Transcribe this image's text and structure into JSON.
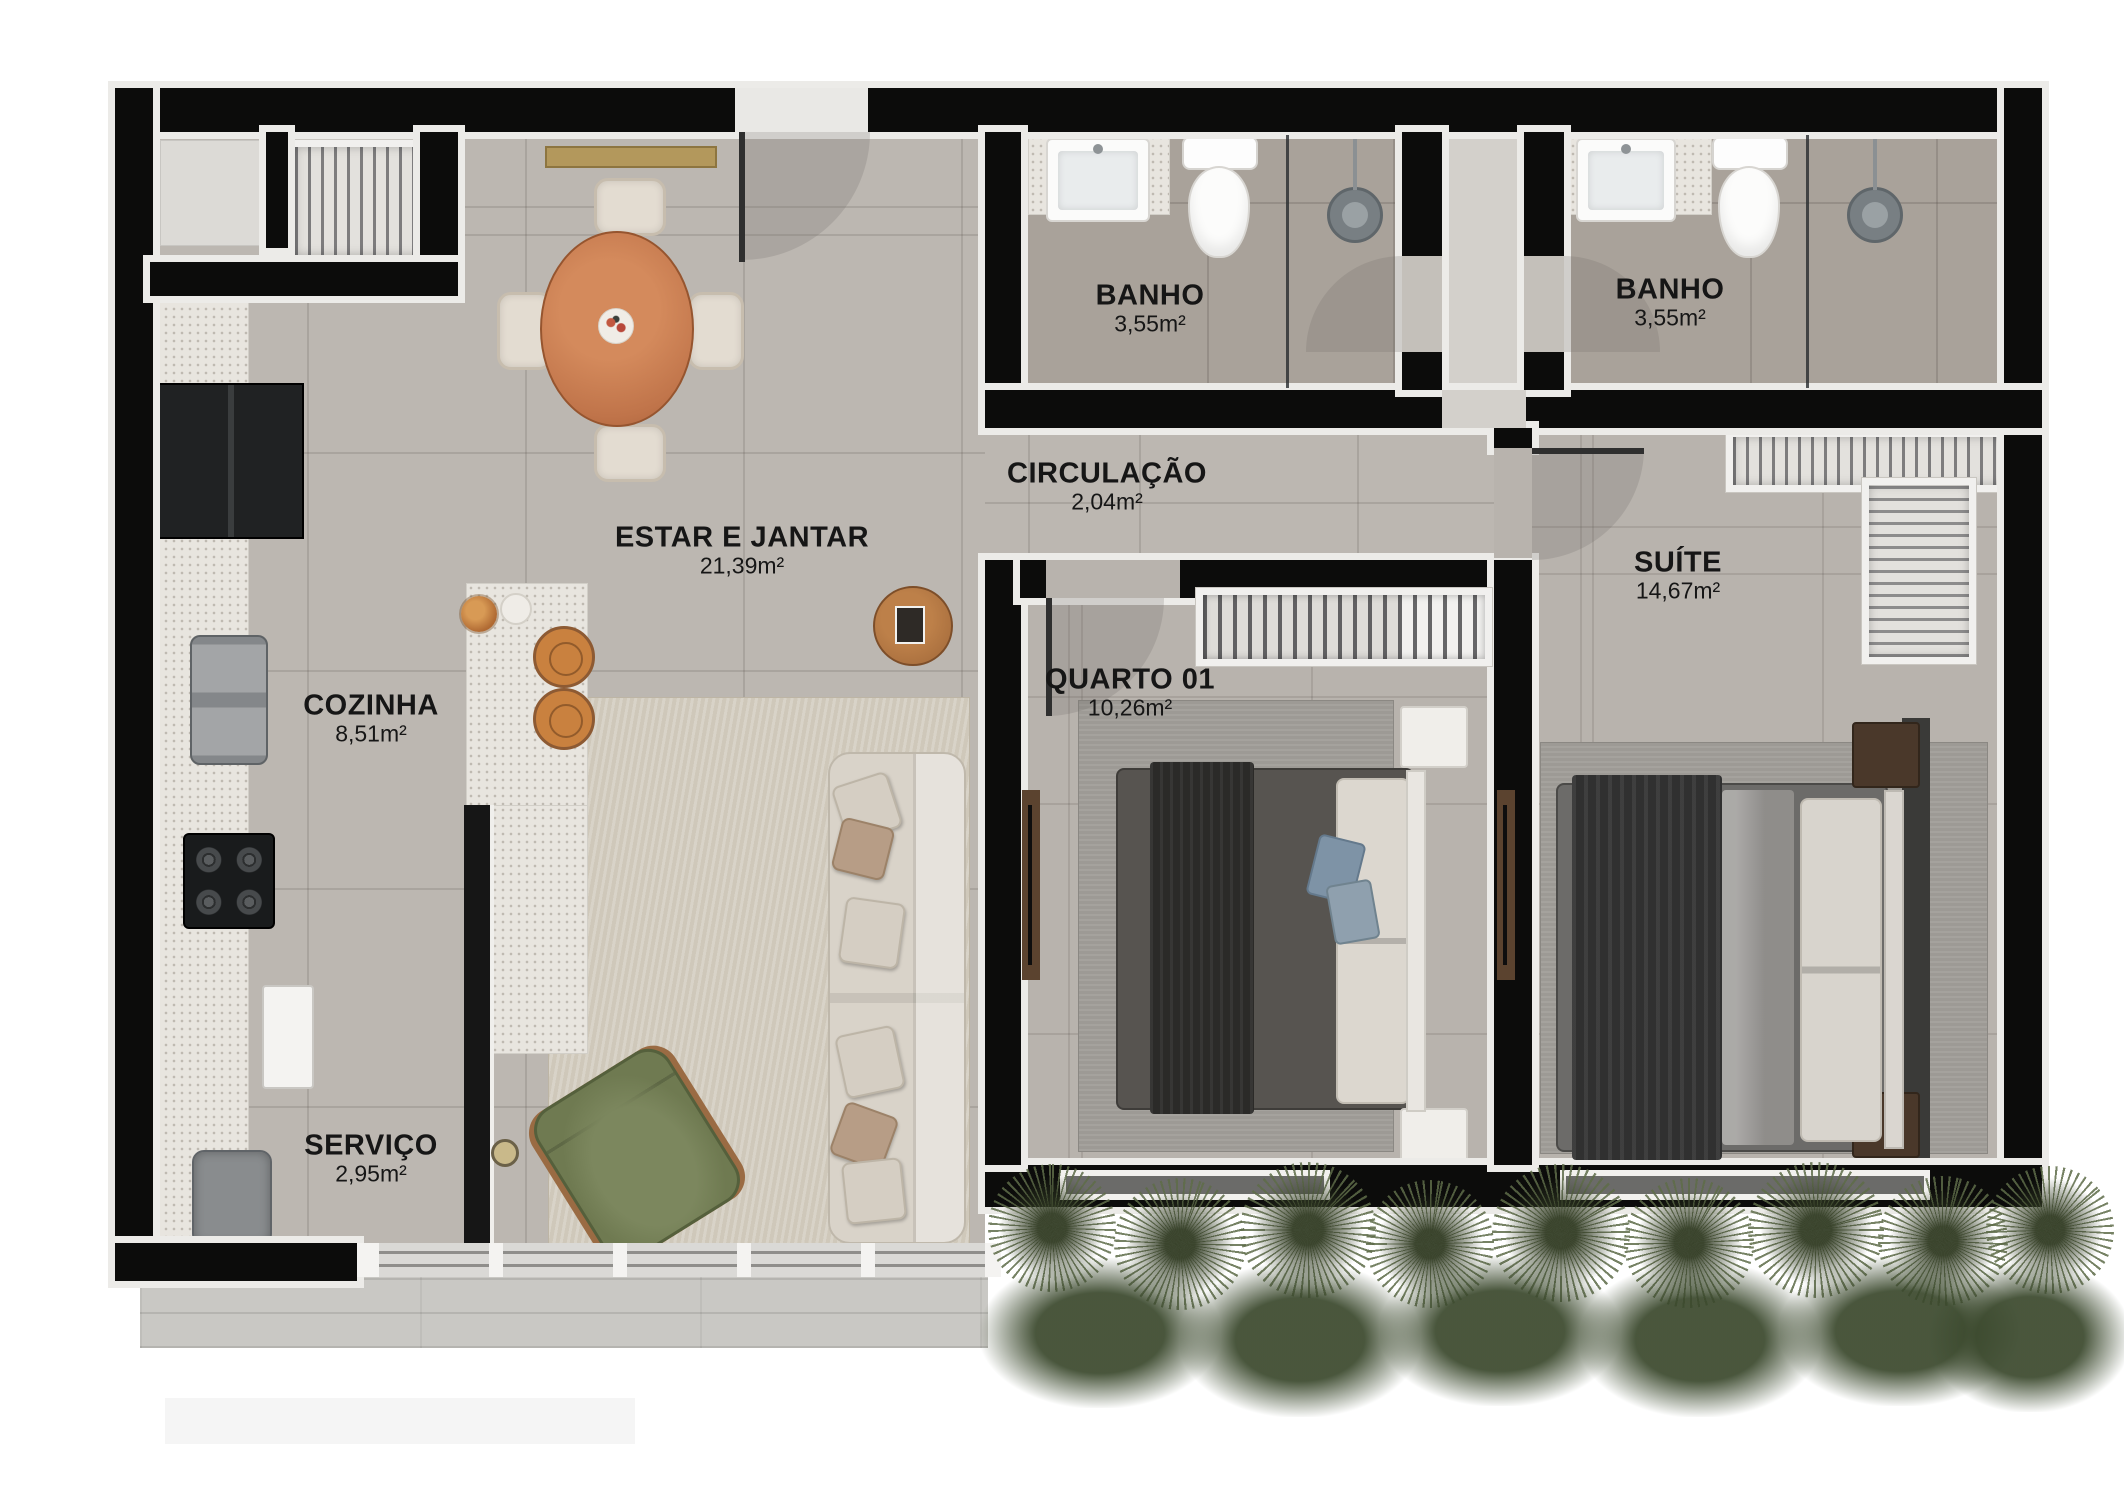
{
  "plan": {
    "title": "apartment-floor-plan",
    "rooms": [
      {
        "id": "estar-jantar",
        "name": "ESTAR E JANTAR",
        "area": "21,39m²"
      },
      {
        "id": "cozinha",
        "name": "COZINHA",
        "area": "8,51m²"
      },
      {
        "id": "servico",
        "name": "SERVIÇO",
        "area": "2,95m²"
      },
      {
        "id": "circulacao",
        "name": "CIRCULAÇÃO",
        "area": "2,04m²"
      },
      {
        "id": "banho-1",
        "name": "BANHO",
        "area": "3,55m²"
      },
      {
        "id": "banho-2",
        "name": "BANHO",
        "area": "3,55m²"
      },
      {
        "id": "quarto-01",
        "name": "QUARTO 01",
        "area": "10,26m²"
      },
      {
        "id": "suite",
        "name": "SUÍTE",
        "area": "14,67m²"
      }
    ],
    "colors": {
      "wall": "#0c0c0b",
      "wall_lining": "#ecebe8",
      "floor_main": "#bcb7b1",
      "floor_bath": "#a9a29a",
      "floor_hall": "#d3d0cb",
      "rug_living": "#cfc8ba",
      "rug_bedroom": "#9d9a95",
      "counter_granite": "#e8e5df",
      "table_wood": "#c97e50",
      "dark_wood": "#4a382a",
      "armchair_green": "#6f7a51",
      "plant_green": "#5e6c49",
      "terrace_concrete": "#c9c8c4",
      "appliance_dark": "#1c1d1e",
      "console_gold": "#b3985c",
      "label_text": "#161616"
    }
  }
}
